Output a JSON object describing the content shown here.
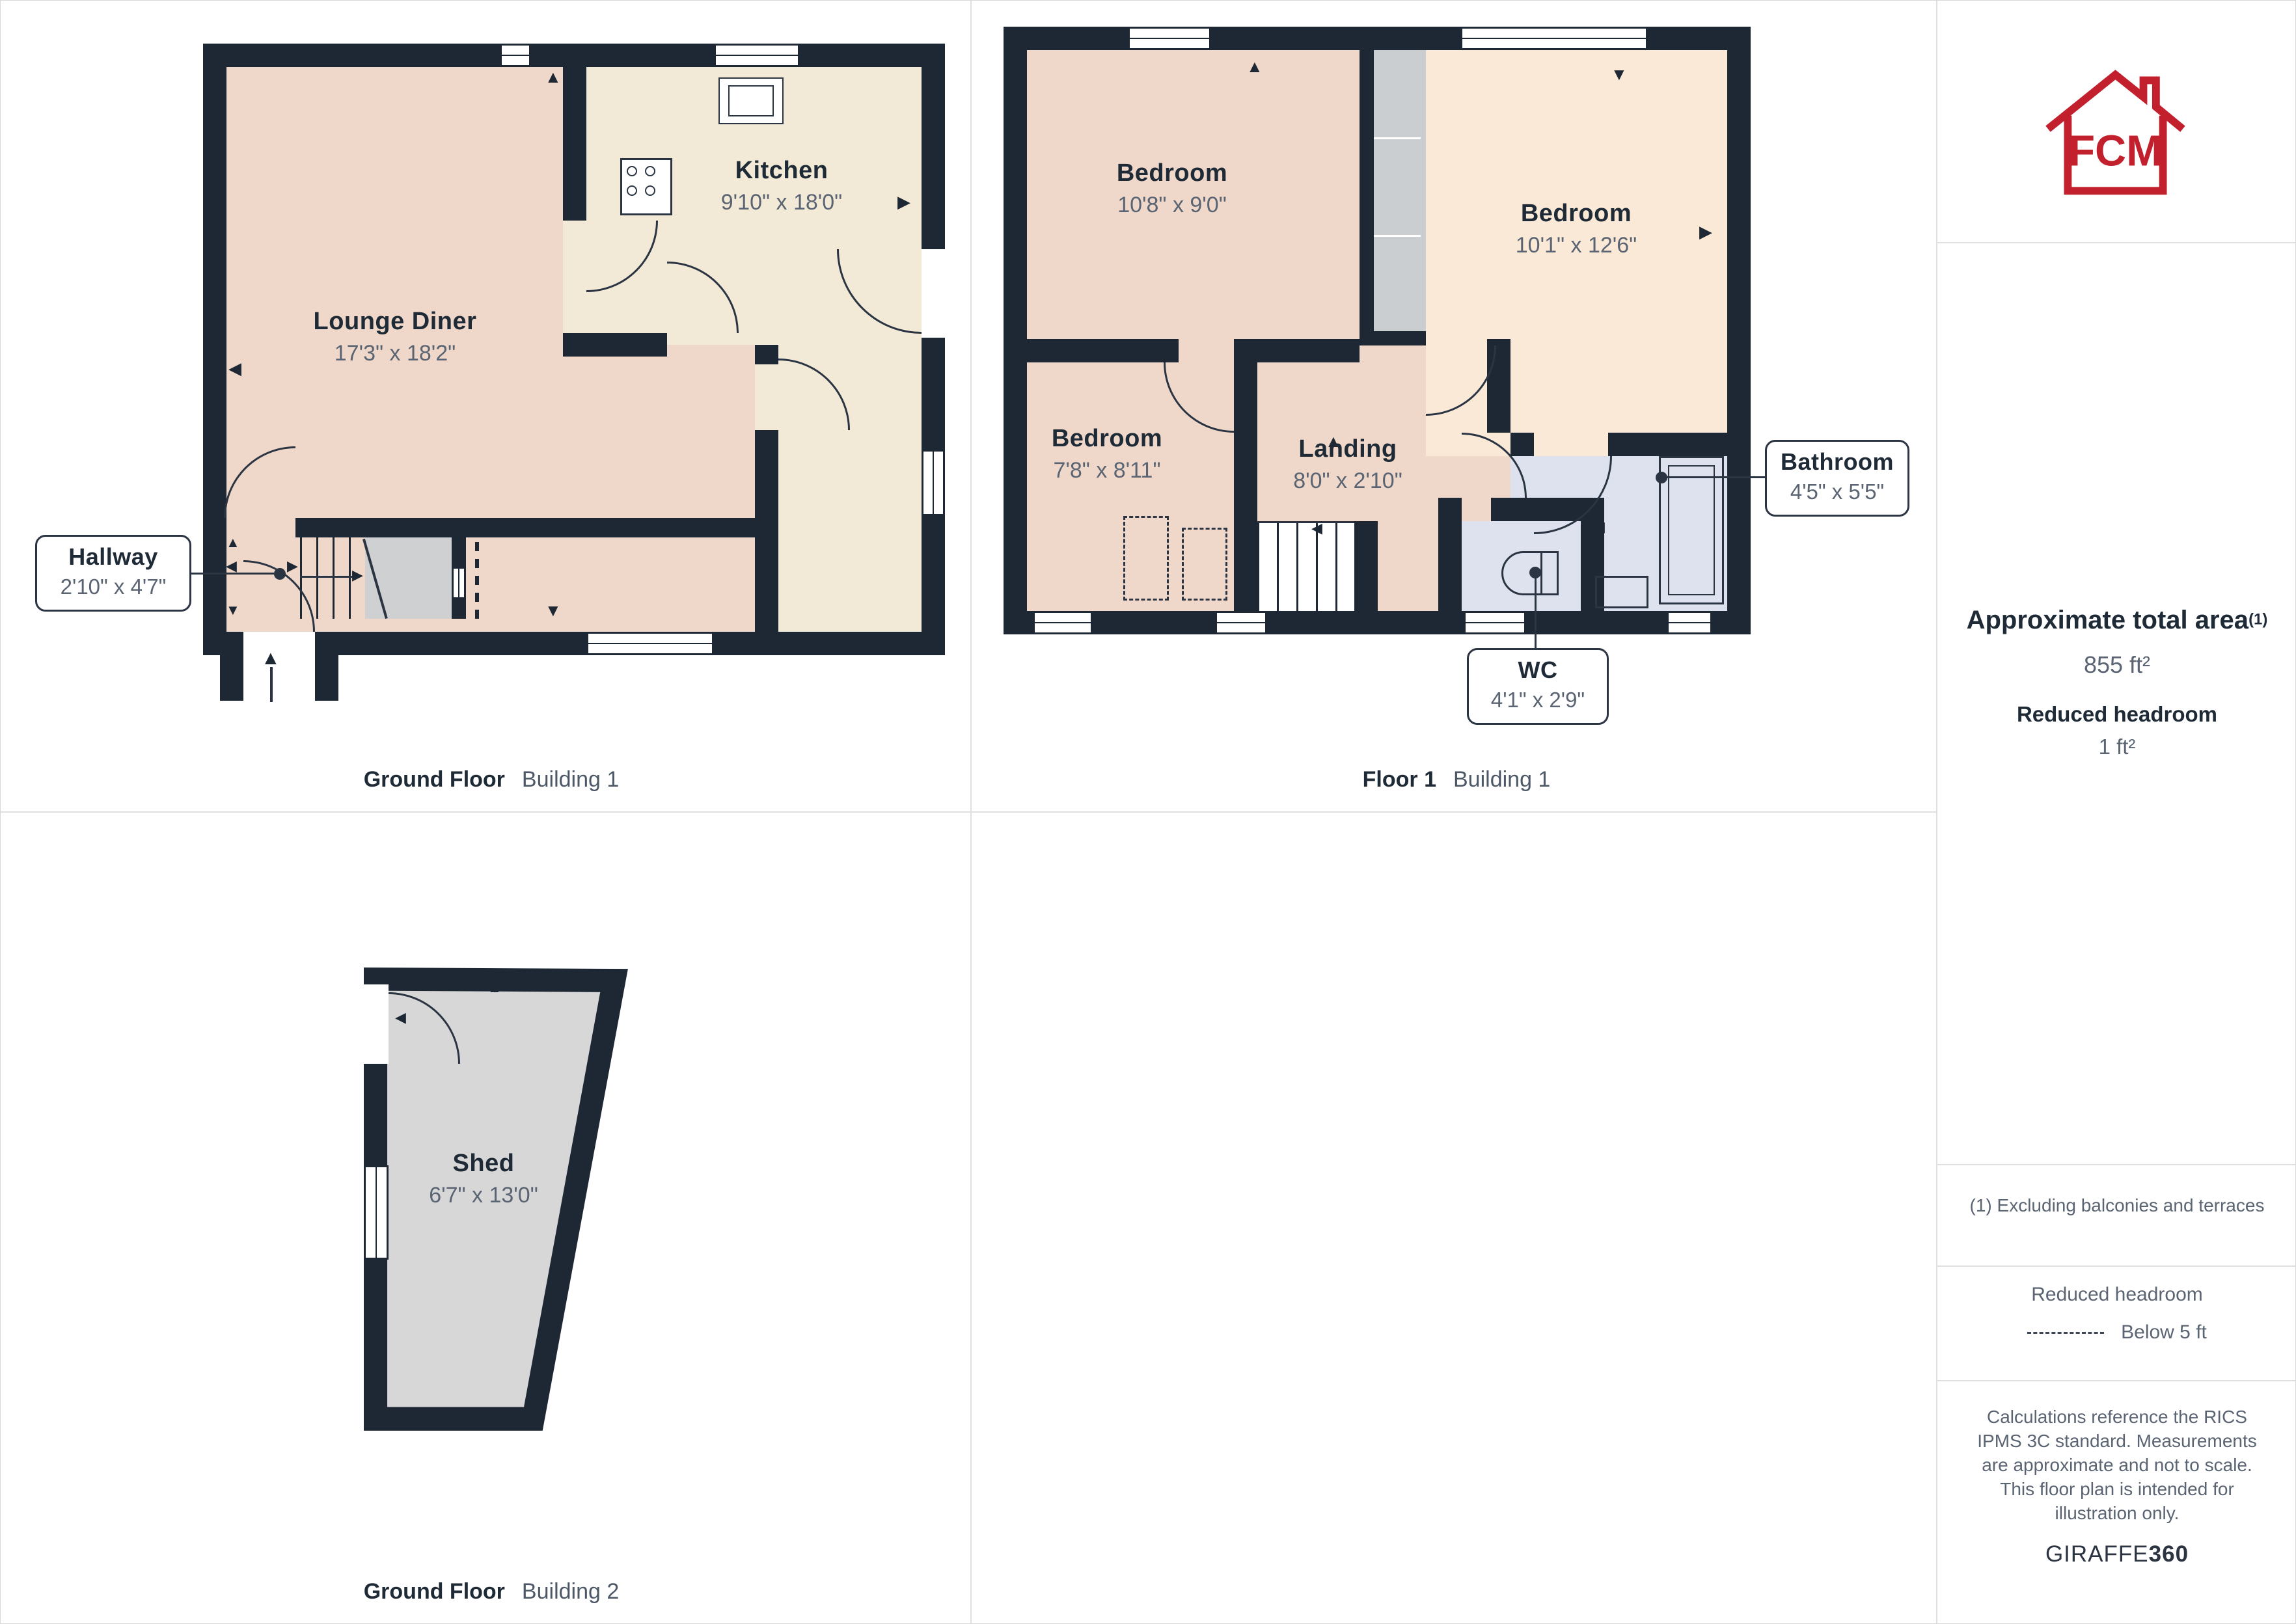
{
  "rooms": {
    "lounge": {
      "name": "Lounge Diner",
      "dims": "17'3\" x 18'2\""
    },
    "kitchen": {
      "name": "Kitchen",
      "dims": "9'10\" x 18'0\""
    },
    "hallway": {
      "name": "Hallway",
      "dims": "2'10\" x 4'7\""
    },
    "bedroom1": {
      "name": "Bedroom",
      "dims": "10'8\" x 9'0\""
    },
    "bedroom2": {
      "name": "Bedroom",
      "dims": "10'1\" x 12'6\""
    },
    "bedroom3": {
      "name": "Bedroom",
      "dims": "7'8\" x 8'11\""
    },
    "landing": {
      "name": "Landing",
      "dims": "8'0\" x 2'10\""
    },
    "bathroom": {
      "name": "Bathroom",
      "dims": "4'5\" x 5'5\""
    },
    "wc": {
      "name": "WC",
      "dims": "4'1\" x 2'9\""
    },
    "shed": {
      "name": "Shed",
      "dims": "6'7\" x 13'0\""
    }
  },
  "captions": {
    "gf1": {
      "floor": "Ground Floor",
      "building": "Building 1"
    },
    "f1": {
      "floor": "Floor 1",
      "building": "Building 1"
    },
    "gf2": {
      "floor": "Ground Floor",
      "building": "Building 2"
    }
  },
  "sidebar": {
    "logo_text": "FCM",
    "total_area_label": "Approximate total area",
    "total_area_sup": "(1)",
    "total_area_value": "855 ft²",
    "reduced_label": "Reduced headroom",
    "reduced_value": "1 ft²",
    "footnote": "(1) Excluding balconies and terraces",
    "legend_title": "Reduced headroom",
    "legend_item": "Below 5 ft",
    "disclaimer": "Calculations reference the RICS IPMS 3C standard. Measurements are approximate and not to scale. This floor plan is intended for illustration only.",
    "brand_normal": "GIRAFFE",
    "brand_bold": "360"
  },
  "icons": {
    "up": "▲",
    "down": "▼",
    "left": "◀",
    "right": "▶"
  },
  "colors": {
    "wall": "#1d2834",
    "line": "#2a3442",
    "pink": "#efd8c9",
    "cream": "#f2ead6",
    "peach": "#fbe9d7",
    "blue": "#dde2ee",
    "closet": "#cbced1",
    "shed": "#d7d7d7",
    "understair": "#cfd0d2",
    "brand_red": "#c2202d",
    "text_dark": "#1f2a37",
    "text_grey": "#5a6472",
    "divider": "#e0e0e0"
  }
}
